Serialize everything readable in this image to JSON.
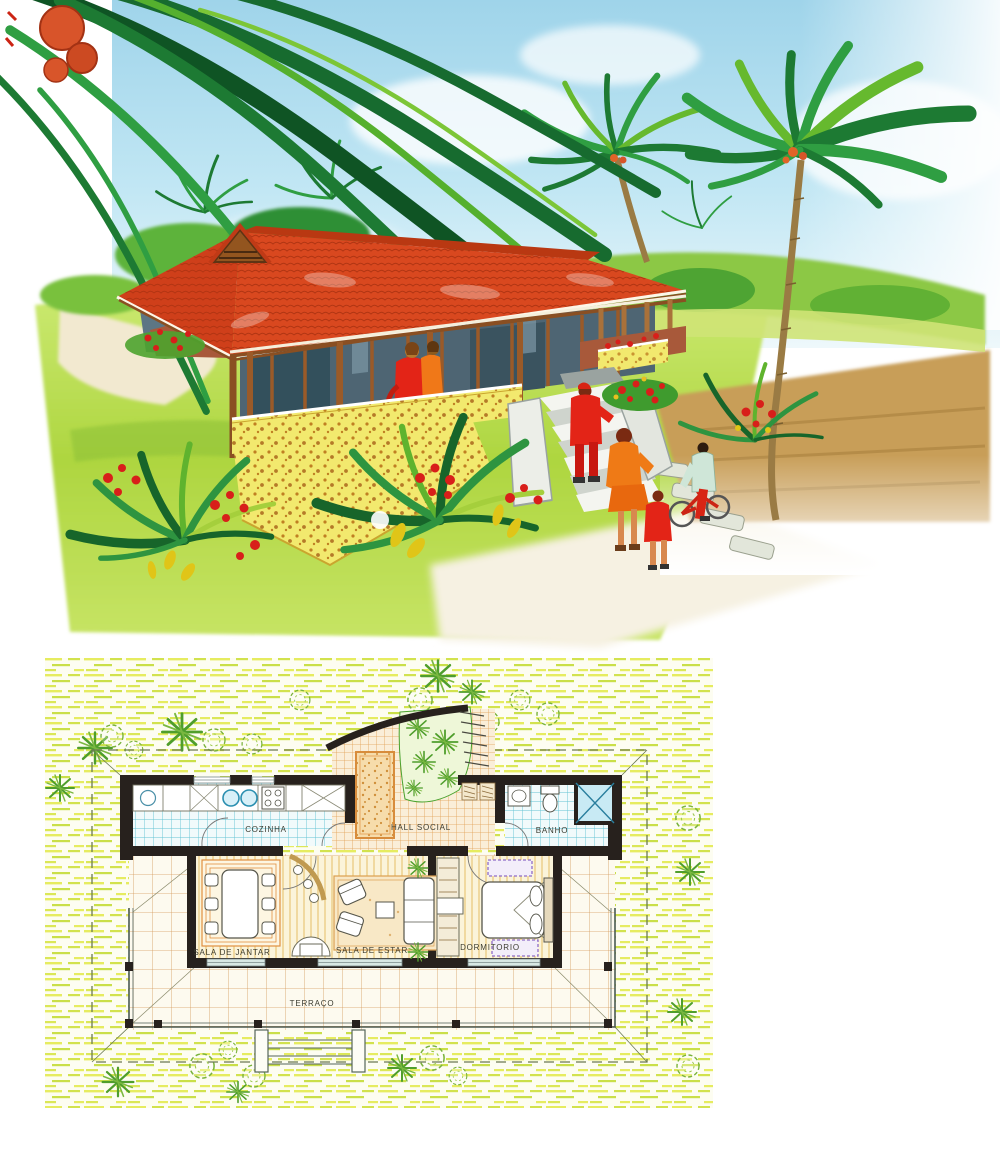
{
  "floor_plan": {
    "labels": {
      "kitchen": "COZINHA",
      "hall": "HALL SOCIAL",
      "bath": "BANHO",
      "dining": "SALA DE JANTAR",
      "living": "SALA DE ESTAR",
      "bedroom": "DORMITORIO",
      "terrace": "TERRAÇO"
    }
  },
  "palette": {
    "sky_blue": "#a9d9ec",
    "foliage_dark": "#1d7a33",
    "foliage_mid": "#2f9e42",
    "foliage_light": "#7cc637",
    "grass_green": "#b5d944",
    "roof_red": "#d9481f",
    "wall_yellow": "#f2e96e",
    "wood_brown": "#8a4f22",
    "window_glass": "#4e6573",
    "deck_brown": "#a8593a",
    "figure_red": "#e32417",
    "figure_orange": "#f07818",
    "sand_tan": "#c89e58",
    "plan_hatch_yellow": "#e6ec60",
    "plan_tile_cyan": "#5ec2d4",
    "plan_tile_orange": "#e0a052",
    "plan_wall_black": "#27211d",
    "plan_plant_green": "#4f9e2c",
    "shower_blue": "#c8eaf4",
    "rug_purple": "#8f6cc8"
  }
}
